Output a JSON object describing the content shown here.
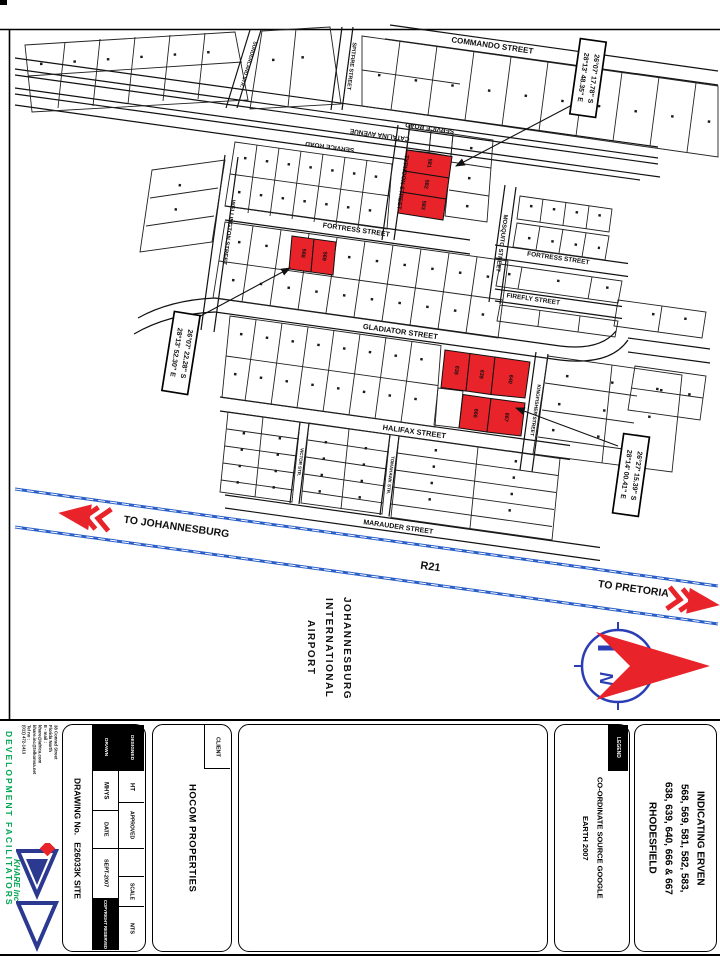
{
  "map": {
    "streets": {
      "commando": "COMMANDO STREET",
      "service_road_upper": "SERVICE ROAD",
      "catalina": "CATALINA AVENUE",
      "service_road_lower": "SERVICE ROAD",
      "sunderland": "SUNDERLAND STR.",
      "spitfire": "SPITFIRE STREET",
      "wellington": "WELLINGTON STREET",
      "typhoon": "TYPHOON STREET",
      "fortress_west": "FORTRESS STREET",
      "fortress_east": "FORTRESS STREET",
      "mosquito": "MOSQUITO STREET",
      "firefly": "FIREFLY STREET",
      "gladiator": "GLADIATOR STREET",
      "kingfisher": "KINGFISHER STREET",
      "halifax": "HALIFAX STREET",
      "victor": "VICTOR STR.",
      "tomahawk": "TOMAHAWK STR.",
      "marauder": "MARAUDER STREET"
    },
    "route": {
      "r21": "R21",
      "to_johannesburg": "TO JOHANNESBURG",
      "to_pretoria": "TO PRETORIA"
    },
    "airport_lines": [
      "JOHANNESBURG",
      "INTERNATIONAL",
      "AIRPORT"
    ],
    "compass_n": "N",
    "callouts": {
      "a": {
        "lat": "26°07' 17.78\" S",
        "lon": "28°13' 48.35\" E"
      },
      "b": {
        "lat": "26°07' 22.28\" S",
        "lon": "28°13' 52.30\" E"
      },
      "c": {
        "lat": "26°27' 15.39\" S",
        "lon": "28°14' 00.41\" E"
      }
    },
    "erven": {
      "a": [
        "581",
        "582",
        "583"
      ],
      "b": [
        "568",
        "569"
      ],
      "c_top": [
        "638",
        "639",
        "640"
      ],
      "c_bottom": [
        "666",
        "667"
      ]
    }
  },
  "title_block": {
    "drawing_no_label": "DRAWING No.",
    "drawing_no_value": "E26033K SITE",
    "cells": {
      "designed_label": "DESIGNED",
      "designed_value": "HT",
      "drawn_label": "DRAWN",
      "drawn_value": "MHYS",
      "date_label": "DATE",
      "date_value": "SEPT-2007",
      "approved_label": "APPROVED",
      "approved_value": "",
      "scale_label": "SCALE",
      "scale_value": "NTS",
      "copyright": "COPYRIGHT RESERVED"
    },
    "client_header": "CLIENT",
    "client_name": "HOCOM PROPERTIES",
    "legend_header": "LEGEND",
    "legend_lines": [
      "CO-ORDINATE SOURCE GOOGLE",
      "EARTH 2007"
    ],
    "title_lines": [
      "INDICATING ERVEN",
      "568, 569, 581, 582, 583,",
      "638, 639, 640, 666 & 667",
      "RHODESFIELD"
    ],
    "firm": {
      "name": "KHARE Inc",
      "tagline": "DEVELOPMENT FACILITATORS",
      "address_lines": [
        "38 Conrad Street",
        "Florida North",
        "E - mail :",
        "khare@iafrica.com",
        "khare.inc@telkomsa.net",
        "Tel no :",
        "(011) 472-1413"
      ]
    }
  },
  "colors": {
    "highlight_red": "#e8232a",
    "highway_blue": "#2a5fc8",
    "compass_blue": "#2b3db5",
    "brand_green": "#00a651",
    "logo_blue": "#2b3990"
  }
}
